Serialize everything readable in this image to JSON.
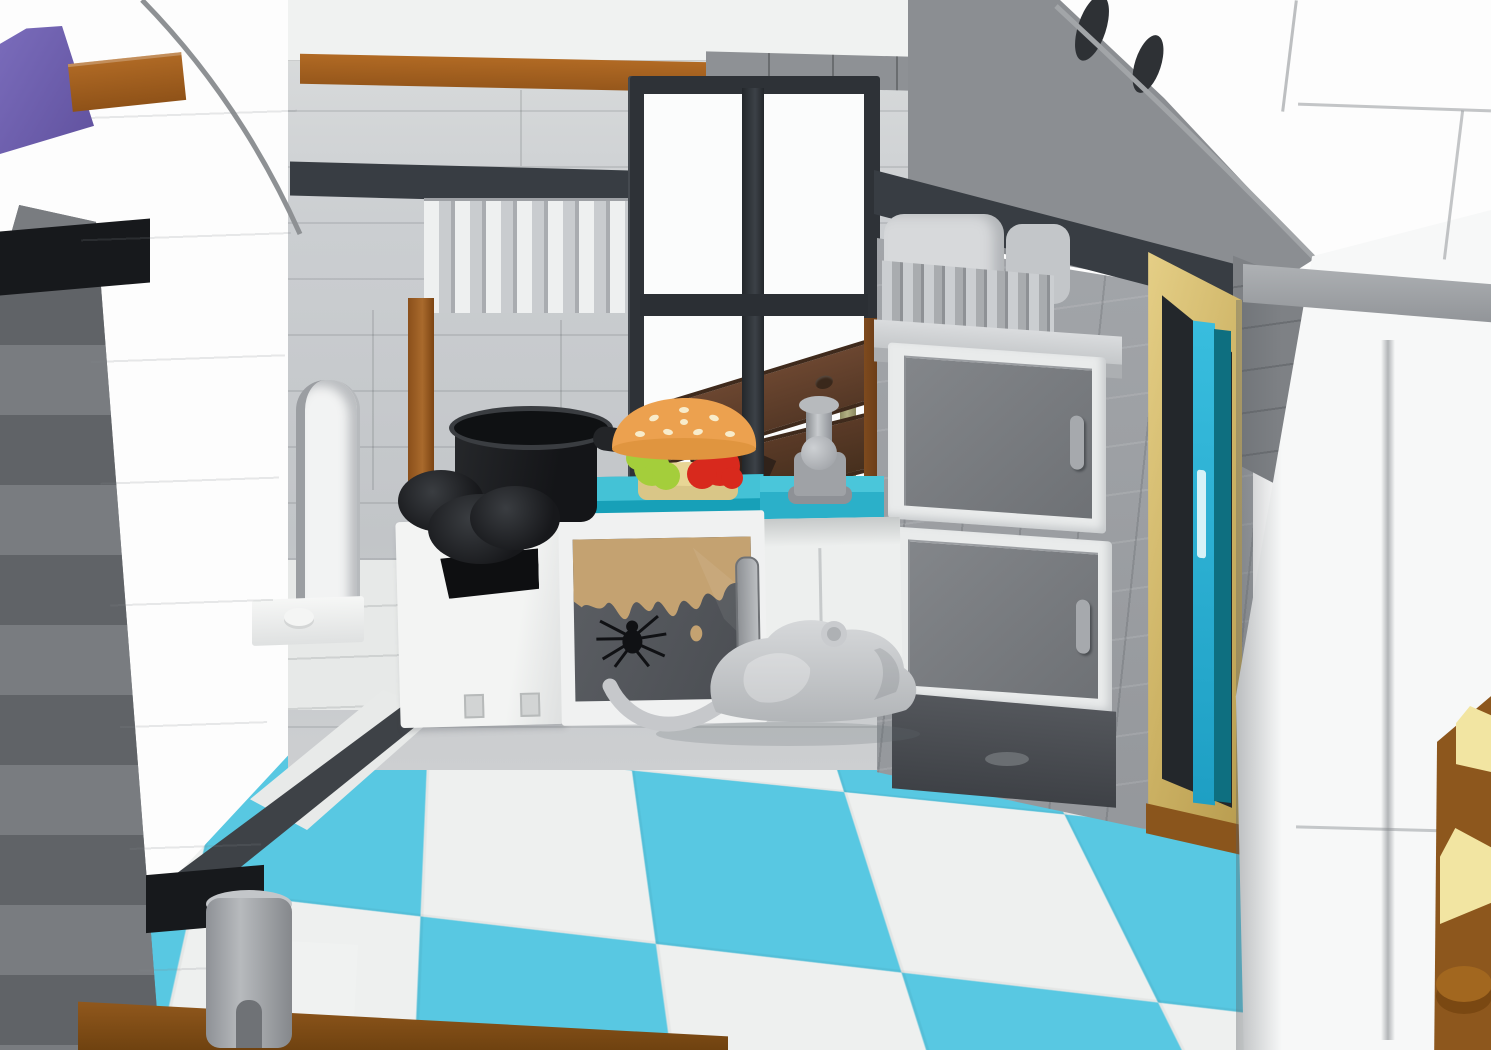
{
  "scene": {
    "title": "LEGO haunted diner kitchen - interior product render",
    "caption": "Interior corner of a LEGO creepy diner kitchen: a black four-pane window boarded up with dark brown planks, olive cacti outside; a teal countertop holding a sesame-bun burger with lettuce and tomato and a grey faucet; a black pot on black burners above a white dishwasher; a white oven whose dark glass door shows a black spider and tan grime; stacked grey-door cabinets under a grey shelf on a stone-grey wall; a golden door frame with a dark teal door; white arched exterior walls, a purple roof corner, brown accent bricks; a light-grey rat on the azure-and-white checkerboard tile floor over a reddish-brown brick base.",
    "objects": [
      {
        "name": "purple-roof-corner",
        "color": "#6F61AE"
      },
      {
        "name": "white-arch-pillar",
        "color": "#F4F5F4"
      },
      {
        "name": "brown-accent-brick",
        "color": "#A2601E"
      },
      {
        "name": "boarded-window",
        "frame_color": "#2E3237",
        "plank_color": "#5B3B27"
      },
      {
        "name": "cactus",
        "color": "#A6A273"
      },
      {
        "name": "burger",
        "bun": "#ECA14F",
        "lettuce": "#A4CE3B",
        "tomato": "#D8291D",
        "bottom_bun": "#DAC787"
      },
      {
        "name": "black-pot",
        "color": "#1C1E21"
      },
      {
        "name": "stove-burners",
        "color": "#232528"
      },
      {
        "name": "dishwasher",
        "color": "#F2F3F2"
      },
      {
        "name": "oven-with-spider-glass",
        "glass": "#53565B",
        "grime": "#C2A06E",
        "spider": "#101114"
      },
      {
        "name": "teal-counter",
        "color": "#1BA5BD"
      },
      {
        "name": "sink",
        "color": "#EDEFEE"
      },
      {
        "name": "faucet",
        "color": "#9FA2A6"
      },
      {
        "name": "grey-cabinets",
        "frame": "#E8EAEA",
        "door": "#75787C"
      },
      {
        "name": "golden-door-frame",
        "color": "#CFB56A"
      },
      {
        "name": "teal-door",
        "bright": "#2BB3D8",
        "dark": "#0E7080"
      },
      {
        "name": "rat",
        "color": "#C9CBCE"
      },
      {
        "name": "checkerboard-floor",
        "azure": "#57C7E1",
        "white": "#EEF0EF"
      },
      {
        "name": "brown-base-plate",
        "color": "#8D571D"
      },
      {
        "name": "tan-tiles",
        "color": "#F2E5A0"
      }
    ],
    "palette": {
      "background": "#FFFFFF",
      "light_wall": "#C6C9CC",
      "medium_wall": "#9C9FA3",
      "dark_slate": "#383D43",
      "black_band": "#17191C",
      "exterior_white": "#F7F8F8"
    }
  }
}
